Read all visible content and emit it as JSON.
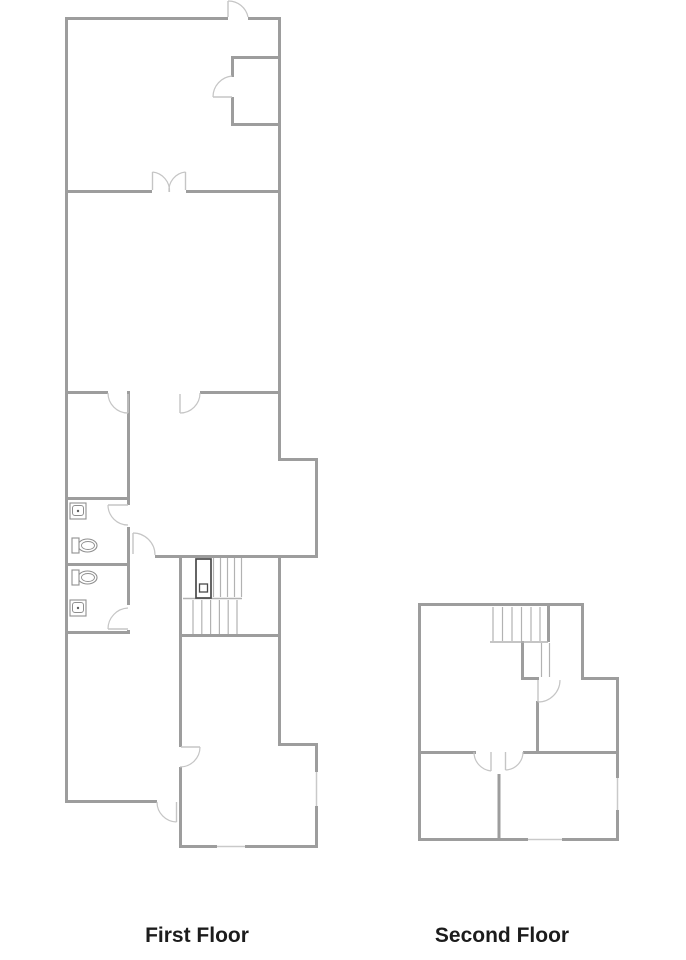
{
  "page": {
    "width": 686,
    "height": 960,
    "background": "#ffffff"
  },
  "colors": {
    "wall": "#9d9d9d",
    "window_line": "#c9c9c9",
    "door": "#c5c5c5",
    "tread": "#b2b2b2",
    "fixture": "#8f8f8f",
    "fixture_dark": "#5f5f5f",
    "elevator": "#4a4a4a",
    "label": "#1c1c1c"
  },
  "floors": [
    {
      "id": "first-floor",
      "label": "First Floor",
      "label_x": 197,
      "label_y": 924,
      "walls": [
        [
          65,
          17,
          163,
          3
        ],
        [
          248,
          17,
          33,
          3
        ],
        [
          65,
          17,
          3,
          786
        ],
        [
          278,
          17,
          3,
          444
        ],
        [
          231,
          56,
          50,
          3
        ],
        [
          231,
          56,
          3,
          21
        ],
        [
          231,
          97,
          3,
          29
        ],
        [
          231,
          123,
          50,
          3
        ],
        [
          65,
          190,
          87,
          3
        ],
        [
          186,
          190,
          95,
          3
        ],
        [
          65,
          391,
          43,
          3
        ],
        [
          200,
          391,
          81,
          3
        ],
        [
          127,
          391,
          3,
          114
        ],
        [
          127,
          527,
          3,
          78
        ],
        [
          127,
          630,
          3,
          4
        ],
        [
          65,
          497,
          65,
          3
        ],
        [
          65,
          563,
          65,
          3
        ],
        [
          65,
          631,
          65,
          3
        ],
        [
          278,
          458,
          40,
          3
        ],
        [
          315,
          458,
          3,
          100
        ],
        [
          155,
          555,
          163,
          3
        ],
        [
          179,
          555,
          3,
          82
        ],
        [
          179,
          634,
          102,
          3
        ],
        [
          278,
          558,
          3,
          188
        ],
        [
          278,
          743,
          40,
          3
        ],
        [
          315,
          743,
          3,
          29
        ],
        [
          315,
          806,
          3,
          42
        ],
        [
          179,
          845,
          38,
          3
        ],
        [
          245,
          845,
          73,
          3
        ],
        [
          179,
          637,
          3,
          110
        ],
        [
          179,
          767,
          3,
          81
        ],
        [
          65,
          800,
          92,
          3
        ]
      ],
      "windows": [
        [
          316.5,
          772,
          316.5,
          806
        ],
        [
          217,
          846.5,
          245,
          846.5
        ]
      ],
      "door_leaves": [
        [
          228,
          1,
          228,
          17
        ],
        [
          213,
          97,
          232,
          97
        ],
        [
          152.5,
          172,
          152.5,
          190
        ],
        [
          185.5,
          172,
          185.5,
          190
        ],
        [
          128,
          394,
          128,
          413
        ],
        [
          180,
          394,
          180,
          413
        ],
        [
          108,
          505,
          128,
          505
        ],
        [
          133,
          533,
          133,
          554
        ],
        [
          108,
          629,
          128,
          629
        ],
        [
          181,
          747,
          200,
          747
        ],
        [
          176.5,
          802,
          176.5,
          822
        ]
      ],
      "door_arcs": [
        "M228,1 A20,20 0 0 1 248,17",
        "M213,97 A21,21 0 0 1 232,76",
        "M152.5,172 A19,19 0 0 1 169.5,192",
        "M185.5,172 A18.5,18.5 0 0 0 169,192",
        "M108,393 A20,20 0 0 0 128,413",
        "M200,393 A20,20 0 0 1 180,413",
        "M108,505 A20,20 0 0 0 128,525",
        "M133,533 A22,22 0 0 1 155,555",
        "M108,629 A21,21 0 0 1 128,608",
        "M200,747 A20,20 0 0 1 180,767",
        "M157,802 A20,20 0 0 0 176.5,822"
      ],
      "stair_treads": [
        [
          213.5,
          558,
          213.5,
          597
        ],
        [
          220.5,
          558,
          220.5,
          597
        ],
        [
          227.5,
          558,
          227.5,
          597
        ],
        [
          234.5,
          558,
          234.5,
          597
        ],
        [
          241.5,
          558,
          241.5,
          597
        ],
        [
          193,
          600,
          193,
          634
        ],
        [
          201.8,
          600,
          201.8,
          634
        ],
        [
          210.6,
          600,
          210.6,
          634
        ],
        [
          219.4,
          600,
          219.4,
          634
        ],
        [
          228.2,
          600,
          228.2,
          634
        ],
        [
          237,
          600,
          237,
          634
        ]
      ],
      "stair_landings": [
        [
          183,
          598.5,
          242,
          598.5
        ]
      ],
      "elevator": {
        "x": 196,
        "y": 559,
        "w": 15,
        "h": 39,
        "inner": [
          199.5,
          584,
          8,
          8
        ]
      },
      "sinks": [
        [
          70,
          503,
          16,
          16
        ],
        [
          70,
          600,
          16,
          16
        ]
      ],
      "toilets": [
        {
          "tank": [
            72,
            538,
            7,
            15
          ],
          "bowl": [
            87.5,
            545.5,
            9.5,
            6.5
          ]
        },
        {
          "tank": [
            72,
            570,
            7,
            15
          ],
          "bowl": [
            87.5,
            577.5,
            9.5,
            6.5
          ]
        }
      ]
    },
    {
      "id": "second-floor",
      "label": "Second Floor",
      "label_x": 502,
      "label_y": 924,
      "walls": [
        [
          418,
          603,
          166,
          3
        ],
        [
          418,
          603,
          3,
          238
        ],
        [
          581,
          603,
          3,
          77
        ],
        [
          581,
          677,
          38,
          3
        ],
        [
          616,
          677,
          3,
          101
        ],
        [
          616,
          810,
          3,
          31
        ],
        [
          418,
          838,
          110,
          3
        ],
        [
          562,
          838,
          57,
          3
        ],
        [
          547,
          603,
          3,
          39
        ],
        [
          521,
          641,
          3,
          39
        ],
        [
          521,
          677,
          18,
          3
        ],
        [
          536,
          701,
          3,
          52
        ],
        [
          418,
          751,
          58,
          3
        ],
        [
          523,
          751,
          96,
          3
        ],
        [
          497.5,
          774,
          3,
          67
        ]
      ],
      "windows": [
        [
          617.5,
          778,
          617.5,
          810
        ],
        [
          528,
          839.5,
          562,
          839.5
        ]
      ],
      "door_leaves": [
        [
          538,
          680,
          538,
          702
        ],
        [
          491,
          752,
          491,
          771
        ],
        [
          505.5,
          752,
          505.5,
          770
        ]
      ],
      "door_arcs": [
        "M538,702 A22,22 0 0 0 560,680",
        "M474,752 A19,19 0 0 0 491,771",
        "M523,752 A18,18 0 0 1 505.5,770"
      ],
      "stair_treads": [
        [
          493,
          607,
          493,
          641
        ],
        [
          502.5,
          607,
          502.5,
          641
        ],
        [
          512,
          607,
          512,
          641
        ],
        [
          521.5,
          607,
          521.5,
          641
        ],
        [
          531,
          607,
          531,
          641
        ],
        [
          540,
          607,
          540,
          641
        ],
        [
          541.5,
          643,
          541.5,
          677
        ],
        [
          549.5,
          643,
          549.5,
          677
        ]
      ],
      "stair_landings": [
        [
          490,
          642,
          548,
          642
        ]
      ],
      "elevator": null,
      "sinks": [],
      "toilets": []
    }
  ]
}
